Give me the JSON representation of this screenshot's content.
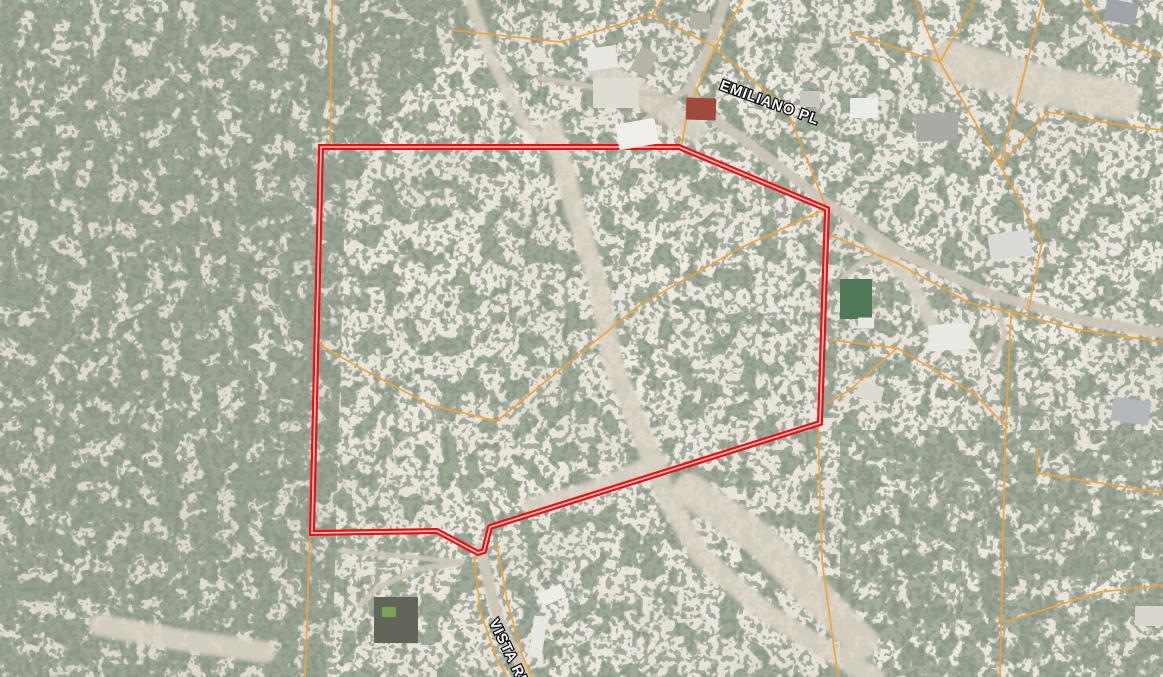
{
  "map": {
    "road_labels": [
      {
        "id": "emiliano-pl",
        "text": "EMILIANO PL",
        "x": 719,
        "y": 89,
        "rotation": 20,
        "size": 14.5
      },
      {
        "id": "vista-re",
        "text": "VISTA RE",
        "x": 489,
        "y": 622,
        "rotation": 64,
        "size": 14.5
      }
    ],
    "boundary": {
      "outer_color": "#e81111",
      "inner_color": "#ffc4c4",
      "points": [
        [
          321,
          147
        ],
        [
          679,
          147
        ],
        [
          827,
          209
        ],
        [
          820,
          423
        ],
        [
          490,
          527
        ],
        [
          484,
          551
        ],
        [
          478,
          553
        ],
        [
          437,
          531
        ],
        [
          312,
          533
        ]
      ]
    },
    "parcel_lines": {
      "color": "#eda43e",
      "lines": [
        [
          [
            332,
            0
          ],
          [
            330,
            148
          ]
        ],
        [
          [
            452,
            30
          ],
          [
            560,
            42
          ],
          [
            652,
            15
          ],
          [
            662,
            0
          ]
        ],
        [
          [
            743,
            0
          ],
          [
            715,
            47
          ],
          [
            688,
            110
          ],
          [
            681,
            147
          ]
        ],
        [
          [
            652,
            15
          ],
          [
            715,
            47
          ],
          [
            787,
            110
          ],
          [
            826,
            207
          ]
        ],
        [
          [
            826,
            207
          ],
          [
            818,
            423
          ],
          [
            822,
            560
          ],
          [
            838,
            677
          ]
        ],
        [
          [
            915,
            0
          ],
          [
            940,
            62
          ],
          [
            1000,
            165
          ],
          [
            1042,
            242
          ],
          [
            1028,
            313
          ]
        ],
        [
          [
            975,
            0
          ],
          [
            940,
            62
          ]
        ],
        [
          [
            850,
            33
          ],
          [
            940,
            62
          ]
        ],
        [
          [
            1000,
            165
          ],
          [
            1048,
            112
          ],
          [
            1125,
            126
          ],
          [
            1163,
            130
          ]
        ],
        [
          [
            1043,
            0
          ],
          [
            1020,
            90
          ],
          [
            1000,
            165
          ]
        ],
        [
          [
            1085,
            0
          ],
          [
            1110,
            35
          ],
          [
            1163,
            58
          ]
        ],
        [
          [
            830,
            235
          ],
          [
            897,
            263
          ],
          [
            970,
            303
          ],
          [
            1011,
            312
          ],
          [
            1080,
            330
          ],
          [
            1163,
            342
          ]
        ],
        [
          [
            1011,
            312
          ],
          [
            1005,
            450
          ],
          [
            1000,
            677
          ]
        ],
        [
          [
            1037,
            450
          ],
          [
            1037,
            473
          ],
          [
            1163,
            493
          ]
        ],
        [
          [
            1005,
            622
          ],
          [
            1100,
            592
          ],
          [
            1163,
            585
          ]
        ],
        [
          [
            320,
            345
          ],
          [
            355,
            365
          ],
          [
            430,
            405
          ],
          [
            497,
            421
          ],
          [
            640,
            305
          ],
          [
            740,
            248
          ],
          [
            826,
            209
          ]
        ],
        [
          [
            830,
            340
          ],
          [
            897,
            348
          ],
          [
            973,
            393
          ],
          [
            1008,
            428
          ]
        ],
        [
          [
            897,
            348
          ],
          [
            850,
            390
          ],
          [
            828,
            403
          ]
        ],
        [
          [
            310,
            536
          ],
          [
            305,
            677
          ]
        ],
        [
          [
            474,
            556
          ],
          [
            480,
            610
          ],
          [
            497,
            660
          ],
          [
            508,
            677
          ]
        ],
        [
          [
            497,
            545
          ],
          [
            507,
            600
          ],
          [
            522,
            655
          ],
          [
            532,
            677
          ]
        ]
      ]
    },
    "roads": [
      {
        "w": 10,
        "pts": [
          [
            725,
            0
          ],
          [
            708,
            50
          ],
          [
            689,
            88
          ],
          [
            700,
            108
          ],
          [
            755,
            148
          ],
          [
            825,
            202
          ],
          [
            900,
            252
          ],
          [
            990,
            294
          ],
          [
            1080,
            320
          ],
          [
            1163,
            333
          ]
        ]
      },
      {
        "w": 7,
        "pts": [
          [
            689,
            88
          ],
          [
            658,
            108
          ],
          [
            636,
            132
          ]
        ]
      },
      {
        "w": 11,
        "pts": [
          [
            480,
            548
          ],
          [
            489,
            585
          ],
          [
            499,
            620
          ],
          [
            514,
            652
          ],
          [
            527,
            677
          ]
        ]
      },
      {
        "w": 6,
        "pts": [
          [
            900,
            252
          ],
          [
            862,
            262
          ],
          [
            843,
            278
          ],
          [
            851,
            296
          ]
        ]
      },
      {
        "w": 6,
        "pts": [
          [
            462,
            562
          ],
          [
            415,
            570
          ],
          [
            377,
            588
          ],
          [
            360,
            606
          ]
        ]
      },
      {
        "w": 5,
        "pts": [
          [
            340,
            551
          ],
          [
            400,
            556
          ],
          [
            462,
            562
          ]
        ]
      },
      {
        "w": 6,
        "pts": [
          [
            540,
            78
          ],
          [
            598,
            88
          ],
          [
            660,
            95
          ]
        ]
      },
      {
        "w": 5,
        "pts": [
          [
            995,
            296
          ],
          [
            1005,
            335
          ],
          [
            990,
            365
          ]
        ]
      }
    ],
    "washes": [
      {
        "w": 20,
        "pts": [
          [
            553,
            128
          ],
          [
            575,
            210
          ],
          [
            600,
            290
          ],
          [
            612,
            360
          ],
          [
            640,
            430
          ],
          [
            668,
            500
          ],
          [
            700,
            555
          ],
          [
            765,
            612
          ],
          [
            835,
            655
          ],
          [
            875,
            677
          ]
        ]
      },
      {
        "w": 12,
        "pts": [
          [
            470,
            0
          ],
          [
            492,
            60
          ],
          [
            522,
            120
          ],
          [
            553,
            150
          ]
        ]
      },
      {
        "w": 34,
        "pts": [
          [
            690,
            490
          ],
          [
            760,
            540
          ],
          [
            820,
            600
          ],
          [
            862,
            642
          ]
        ]
      },
      {
        "w": 22,
        "pts": [
          [
            100,
            625
          ],
          [
            180,
            640
          ],
          [
            265,
            652
          ]
        ]
      },
      {
        "w": 40,
        "pts": [
          [
            950,
            60
          ],
          [
            1040,
            85
          ],
          [
            1120,
            100
          ]
        ]
      },
      {
        "w": 24,
        "pts": [
          [
            600,
            70
          ],
          [
            650,
            100
          ],
          [
            695,
            130
          ]
        ]
      },
      {
        "w": 14,
        "pts": [
          [
            870,
            240
          ],
          [
            910,
            280
          ],
          [
            935,
            330
          ]
        ]
      },
      {
        "w": 16,
        "pts": [
          [
            660,
            460
          ],
          [
            590,
            490
          ],
          [
            530,
            505
          ]
        ]
      }
    ],
    "ridges": [
      [
        [
          15,
          190
        ],
        [
          120,
          140
        ]
      ],
      [
        [
          10,
          300
        ],
        [
          150,
          235
        ]
      ],
      [
        [
          35,
          420
        ],
        [
          185,
          335
        ]
      ],
      [
        [
          55,
          545
        ],
        [
          215,
          425
        ]
      ],
      [
        [
          90,
          655
        ],
        [
          255,
          520
        ]
      ],
      [
        [
          150,
          60
        ],
        [
          240,
          20
        ]
      ],
      [
        [
          200,
          250
        ],
        [
          300,
          190
        ]
      ],
      [
        [
          230,
          420
        ],
        [
          310,
          360
        ]
      ],
      [
        [
          250,
          560
        ],
        [
          320,
          500
        ]
      ]
    ],
    "buildings": [
      [
        602,
        58,
        30,
        22,
        -8,
        "#e9e7e1"
      ],
      [
        616,
        93,
        46,
        30,
        0,
        "#dfdcd3"
      ],
      [
        644,
        62,
        18,
        26,
        28,
        "#b8b4aa"
      ],
      [
        701,
        109,
        30,
        22,
        2,
        "#a04a3c"
      ],
      [
        637,
        134,
        40,
        26,
        -10,
        "#f1efe9"
      ],
      [
        864,
        108,
        28,
        20,
        0,
        "#ebedec"
      ],
      [
        937,
        127,
        42,
        28,
        -2,
        "#a9a9a5"
      ],
      [
        1121,
        12,
        32,
        22,
        12,
        "#9fa5a9"
      ],
      [
        810,
        99,
        20,
        16,
        0,
        "#c9c7bf"
      ],
      [
        856,
        299,
        32,
        40,
        0,
        "#50795a"
      ],
      [
        866,
        323,
        16,
        11,
        0,
        "#e8e8e4"
      ],
      [
        1010,
        245,
        42,
        26,
        -8,
        "#dadad6"
      ],
      [
        949,
        337,
        40,
        26,
        -4,
        "#eae9e5"
      ],
      [
        870,
        392,
        26,
        16,
        14,
        "#dedad1"
      ],
      [
        1131,
        411,
        38,
        24,
        8,
        "#b4b8bc"
      ],
      [
        1149,
        616,
        28,
        20,
        0,
        "#d8d6ce"
      ],
      [
        552,
        595,
        26,
        14,
        -25,
        "#efede7"
      ],
      [
        538,
        637,
        13,
        42,
        8,
        "#e9e7e1"
      ],
      [
        396,
        620,
        44,
        46,
        0,
        "#62665a"
      ],
      [
        389,
        612,
        14,
        10,
        0,
        "#79a357"
      ],
      [
        700,
        21,
        20,
        16,
        0,
        "#b5b1a7"
      ]
    ],
    "terrain_colors": {
      "base": "#c9c3b5",
      "vegetation": "#545f4c",
      "wash": "#d9d3c5",
      "road": "#cdc7b8",
      "badlands_tint": "#a8a295"
    }
  }
}
